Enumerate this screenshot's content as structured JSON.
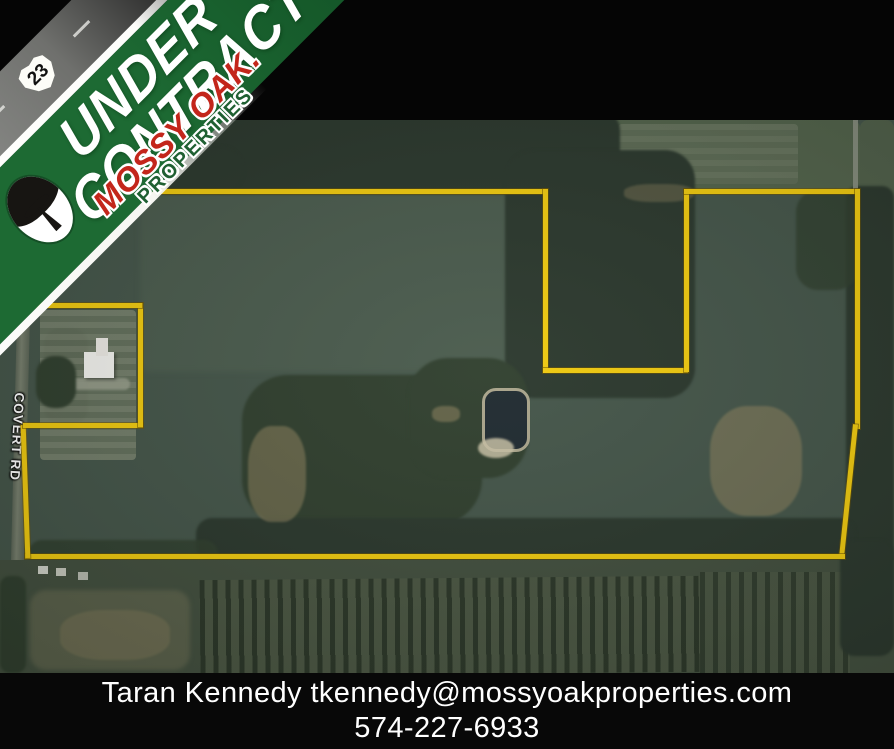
{
  "banner": {
    "line1": "UNDER",
    "line2": "CONTRACT",
    "green": "#1d6a33"
  },
  "logo": {
    "brand": "MOSSY OAK.",
    "sub": "PROPERTIES",
    "brand_red": "#c3261b",
    "sub_green": "#1f6032"
  },
  "route_shield": {
    "number": "23"
  },
  "map": {
    "road_label": "COVERT RD",
    "boundary_color": "#f0ca10"
  },
  "contact": {
    "name": "Taran Kennedy",
    "email": "tkennedy@mossyoakproperties.com",
    "phone": "574-227-6933"
  }
}
